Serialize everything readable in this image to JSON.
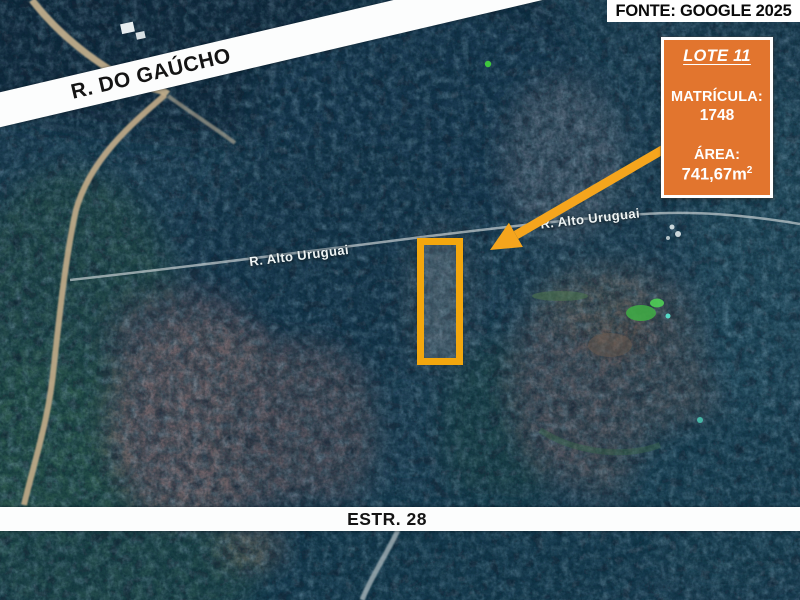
{
  "header": {
    "source_credit": "FONTE: GOOGLE 2025"
  },
  "roads": {
    "gaucho_label": "R. DO GAÚCHO",
    "estrada_label": "ESTR. 28",
    "alto_uruguai_label_left": "R. Alto Uruguai",
    "alto_uruguai_label_right": "R. Alto Uruguai"
  },
  "lot_callout": {
    "title": "LOTE 11",
    "registry_label": "MATRÍCULA:",
    "registry_number": "1748",
    "area_label": "ÁREA:",
    "area_value": "741,67m",
    "area_exponent": "2",
    "box_color": "#e2752e",
    "highlight_color": "#f3a70e"
  }
}
